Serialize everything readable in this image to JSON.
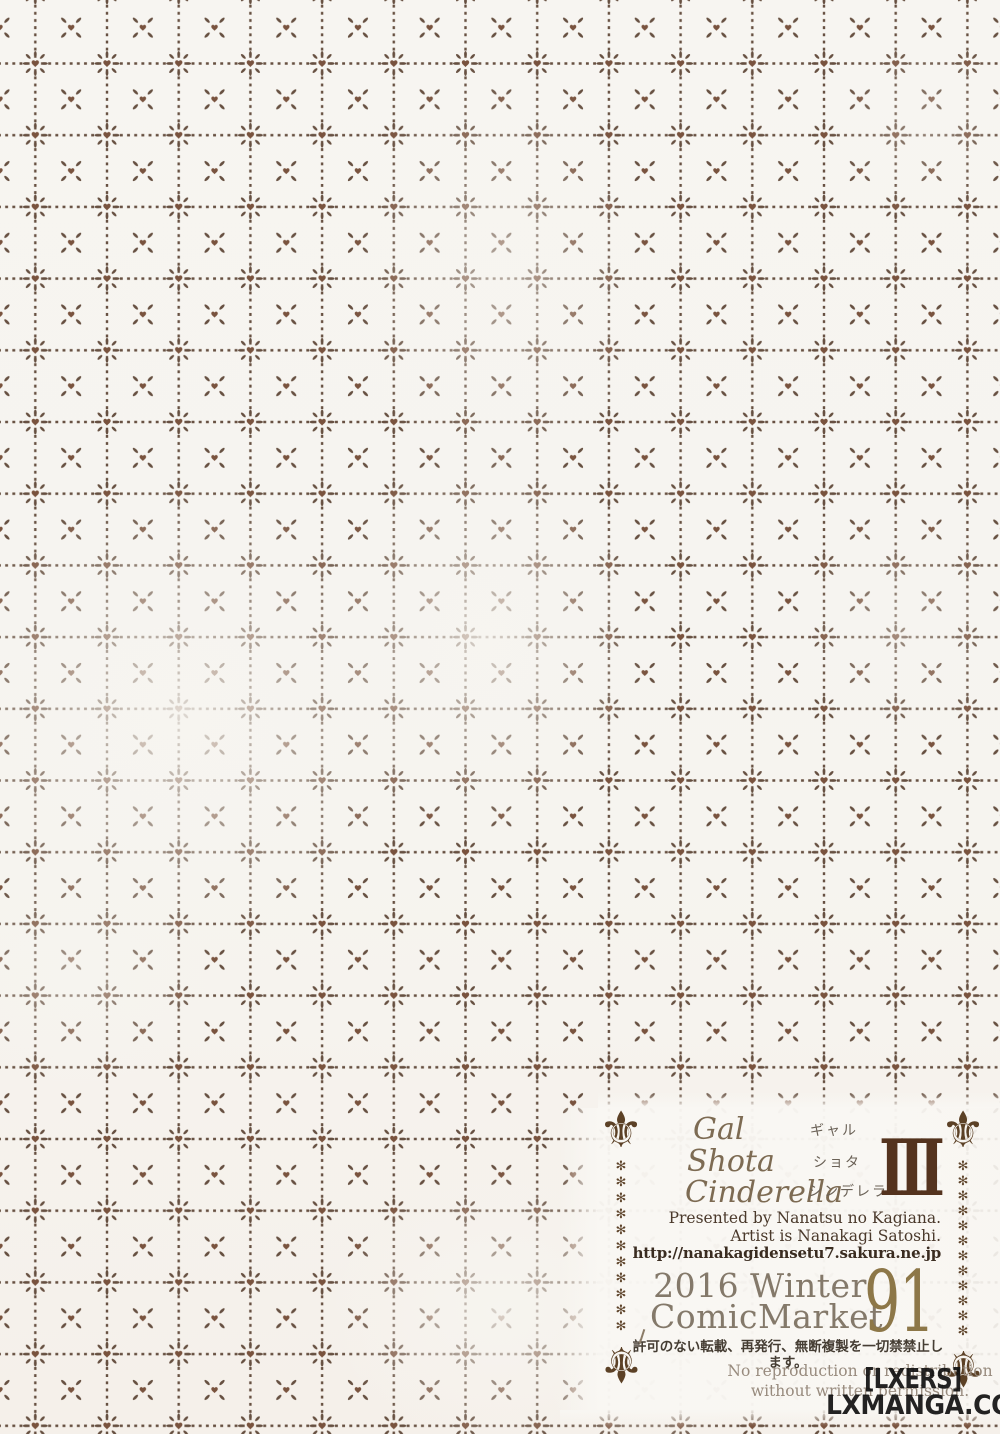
{
  "colors": {
    "page_bg": "#f6f4ef",
    "pattern_dash": "#5a4232",
    "pattern_heart": "#6e452f",
    "title_script": "#7d6b53",
    "numeral_brown": "#54331e",
    "event_gray": "#84796a",
    "number_gold": "#8d7748",
    "ornament_brown": "#5c4126",
    "watermark_black": "#0c0c0c"
  },
  "colophon": {
    "title": {
      "line1": "Gal",
      "line2": "Shota",
      "line3": "Cinderella",
      "kana1": "ギャル",
      "kana2": "ショタ",
      "kana3": "シンデレラ",
      "numeral": "III"
    },
    "credits": {
      "line1": "Presented by Nanatsu no Kagiana.",
      "line2": "Artist is Nanakagi Satoshi.",
      "url": "http://nanakagidensetu7.sakura.ne.jp"
    },
    "event": {
      "line1": "2016 Winter",
      "line2": "ComicMarket",
      "number": "91"
    },
    "notice": {
      "jp": "許可のない転載、再発行、無断複製を一切禁禁止します。",
      "en1": "No reproduction or redistribution",
      "en2": "without written permission."
    },
    "ornament": {
      "fleur": "⚜",
      "asterisks_left": "✻\n✻\n✻\n✻\n✻\n✻\n✻\n✻\n✻\n✻\n✻",
      "asterisks_right": "✻\n✻\n✻\n✻\n✻\n✻\n✻\n✻\n✻\n✻\n✻\n✻"
    }
  },
  "watermark": {
    "line1": "[LXERS]",
    "line2": "LXMANGA.COM"
  }
}
